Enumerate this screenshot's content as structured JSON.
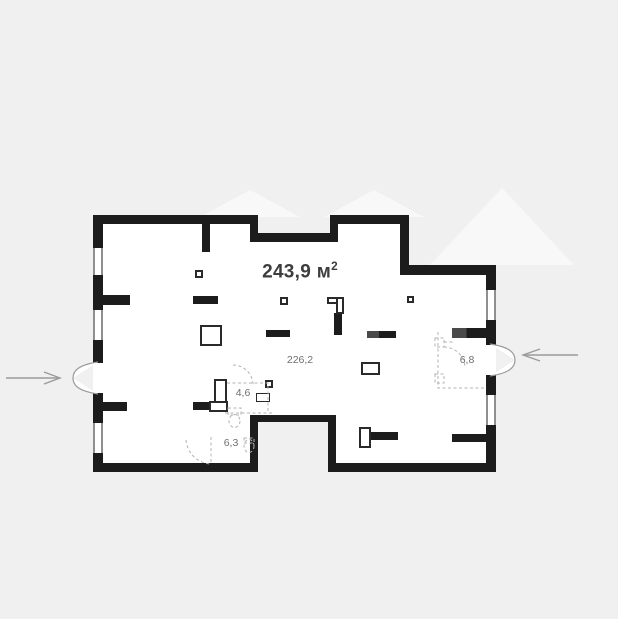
{
  "plan": {
    "total_area": {
      "value": "243,9",
      "unit": "м",
      "sup": "2"
    },
    "labels": {
      "main_room": "226,2",
      "vestibule": "6,8",
      "bathroom": "4,6",
      "wc": "6,3"
    }
  },
  "colors": {
    "background": "#f0f0f1",
    "watermark": "#f8f8f9",
    "wall": "#1c1c1c",
    "wall_accent": "#4a4a4a",
    "floor": "#ffffff",
    "outline": "#2a2a2a",
    "window_frame": "#8f8f8f",
    "dashed": "#b3b3b3",
    "door_arc": "#9a9a9a",
    "arrow": "#9b9b9b",
    "area_text": "#3d3d3d",
    "room_text": "#6f6f6f"
  }
}
